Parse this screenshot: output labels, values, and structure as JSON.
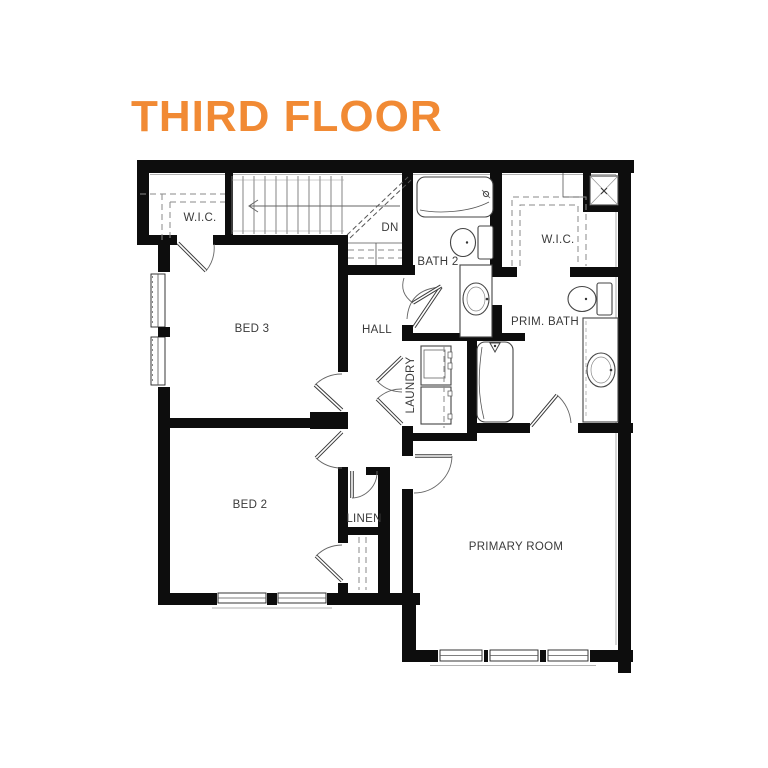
{
  "title": "THIRD FLOOR",
  "accent_color": "#F18A34",
  "plan": {
    "rooms": [
      {
        "id": "wic-left",
        "label": "W.I.C."
      },
      {
        "id": "stairs",
        "label": "DN"
      },
      {
        "id": "bath-2",
        "label": "BATH 2"
      },
      {
        "id": "wic-right",
        "label": "W.I.C."
      },
      {
        "id": "bed-3",
        "label": "BED 3"
      },
      {
        "id": "hall",
        "label": "HALL"
      },
      {
        "id": "primary-bath",
        "label": "PRIM. BATH"
      },
      {
        "id": "laundry",
        "label": "LAUNDRY"
      },
      {
        "id": "bed-2",
        "label": "BED 2"
      },
      {
        "id": "linen",
        "label": "LINEN"
      },
      {
        "id": "primary-room",
        "label": "PRIMARY ROOM"
      }
    ],
    "fixtures": [
      "bathtub",
      "toilet",
      "vanity-sink",
      "shower",
      "washer",
      "dryer"
    ],
    "window_count": 7,
    "wall_color": "#0d0d0d"
  }
}
